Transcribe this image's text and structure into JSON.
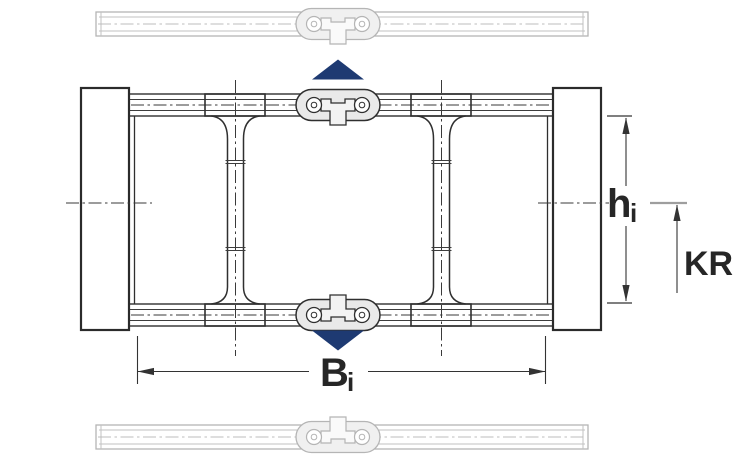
{
  "diagram": {
    "dimension_labels": {
      "inner_width": {
        "symbol": "B",
        "subscript": "i"
      },
      "inner_height": {
        "symbol": "h",
        "subscript": "i"
      },
      "bend_radius": "KR"
    },
    "colors": {
      "inner_height_label": "#c10e3f",
      "inner_width_label": "#262626",
      "bend_radius_label": "#262626",
      "motion_arrow": "#1e3a72",
      "drawing_line": "#2f2f2f",
      "ghost_profile": "#b5b5b5"
    }
  }
}
